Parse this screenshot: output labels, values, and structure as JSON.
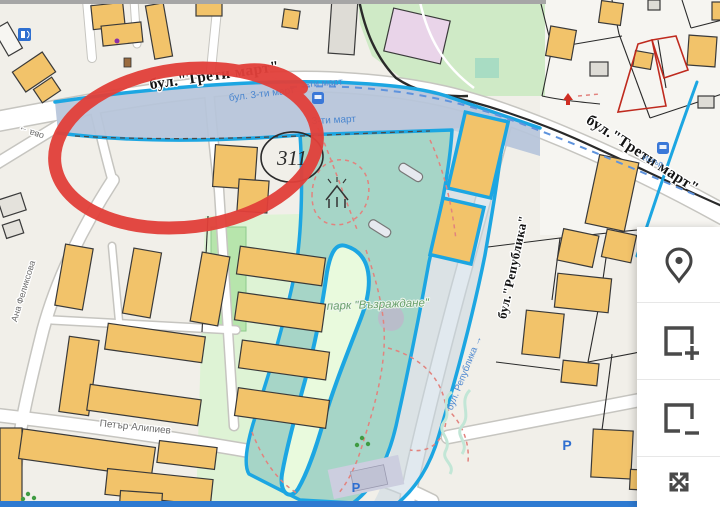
{
  "map": {
    "streets": {
      "treti_mart_left": "бул.\"Трети март\"",
      "treti_mart_right": "бул.\"Трети март\"",
      "treti_mart_blue_full": "бул. 3-ти март",
      "treti_mart_blue_short_a": "3-ти март",
      "treti_mart_blue_short_b": "3-ти март",
      "republika_black": "бул.\"Република\"",
      "republika_blue": "бул. Република →",
      "ana_felixova": "Ана Феликсова",
      "petar_alipiev": "Петър Алипиев",
      "minor_street_partial": "ова →",
      "bus_stop": "Истър"
    },
    "places": {
      "park_name": "парк \"Възраждане\"",
      "plot_number": "311",
      "parking_a": "P",
      "parking_b": "P"
    },
    "legend_colors": {
      "building_fill": "#F2C36A",
      "selection_outline": "#1CA6E2",
      "selection_fill": "#A6D5C7",
      "water_strip": "#B6C4DA",
      "annotation_red": "#E2403A",
      "road_label_blue": "#4A86CF",
      "park_green": "#CFEAC6",
      "restricted_parcel_red": "#C0271C"
    },
    "annotation": {
      "type": "hand-drawn-ellipse",
      "color": "#E2403A"
    }
  },
  "toolbar": {
    "buttons": [
      {
        "icon": "location-marker-icon"
      },
      {
        "icon": "add-area-icon"
      },
      {
        "icon": "remove-area-icon"
      },
      {
        "icon": "expand-icon"
      }
    ]
  }
}
